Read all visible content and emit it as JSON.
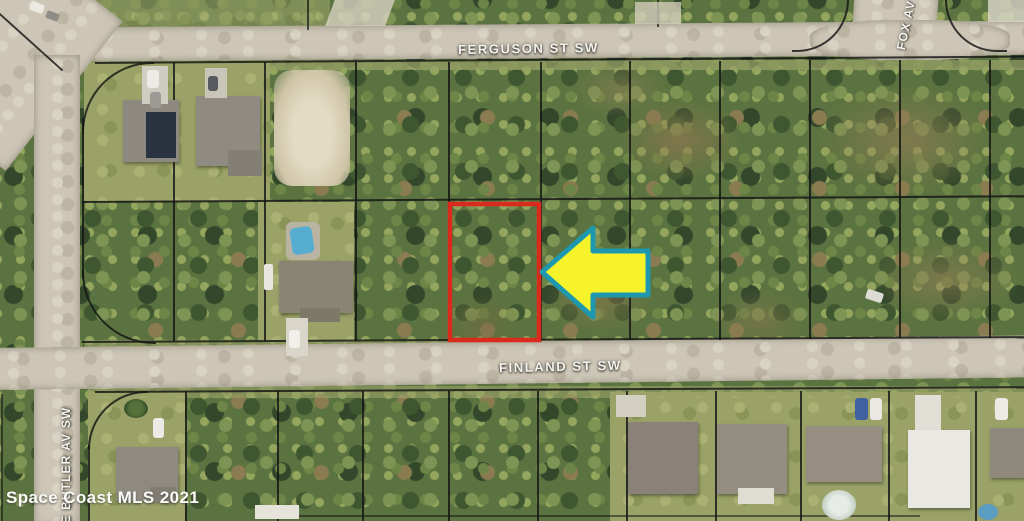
{
  "map": {
    "street_labels": [
      {
        "id": "ferguson",
        "text": "FERGUSON ST SW"
      },
      {
        "id": "finland",
        "text": "FINLAND ST SW"
      },
      {
        "id": "fox",
        "text": "FOX AV"
      },
      {
        "id": "butler",
        "text": "E BUTLER AV SW"
      }
    ],
    "watermark": "Space Coast MLS 2021",
    "highlight": {
      "parcel_outline_color": "#da2a1d",
      "arrow_fill": "#f7f32b",
      "arrow_border": "#1e98ae",
      "arrow_direction": "left"
    },
    "colors": {
      "vegetation": "#5b7340",
      "lawn": "#9aa268",
      "road": "#cdc6b6",
      "parcel_line": "#151515"
    }
  }
}
